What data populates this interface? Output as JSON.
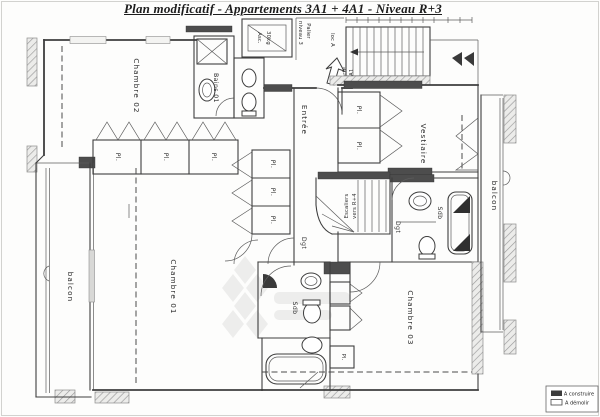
{
  "title": {
    "text": "Plan modificatif - Appartements 3A1 + 4A1 - Niveau R+3"
  },
  "labels": {
    "chambre01": "Chambre 01",
    "chambre02": "Chambre 02",
    "chambre03": "Chambre 03",
    "vestiaire": "Vestiaire",
    "entree": "Entrée",
    "bains01": "Bains 01",
    "sdb_center": "Sdb",
    "sdb_right": "Sdb",
    "dgt_left": "Dgt",
    "dgt_right": "Dgt",
    "balcon_left": "balcon",
    "balcon_right": "balcon",
    "asc1": "Asc.",
    "asc2": "30kg",
    "loc_a": "loc A",
    "palier1": "Palier",
    "palier2": "niveau 3",
    "esc1": "Escaliers",
    "esc2": "vers R+4",
    "porte1": "Porte",
    "porte2": "3A1",
    "pl": "Pl."
  },
  "legend": {
    "items": [
      {
        "swatch": "filled",
        "label": "A construire"
      },
      {
        "swatch": "outline",
        "label": "A démolir"
      }
    ]
  },
  "icons": {
    "shower": "square-with-diagonal-cross",
    "shower_corner": "black-quarter-fan",
    "sink": "oval-basin",
    "toilet": "oval-with-tank",
    "bathtub": "rounded-rect",
    "stairs": "parallel-treads-with-arrow",
    "door": "quarter-arc",
    "entry_arrow": "outline-arrow",
    "elevator": "nested-rects",
    "watermark": "diamond-grid"
  },
  "colors": {
    "ink": "#3e3e3e",
    "new_wall": "#4d4d4d",
    "existing_hatch": "#9a9a9a",
    "paper": "#fdfdfc"
  }
}
